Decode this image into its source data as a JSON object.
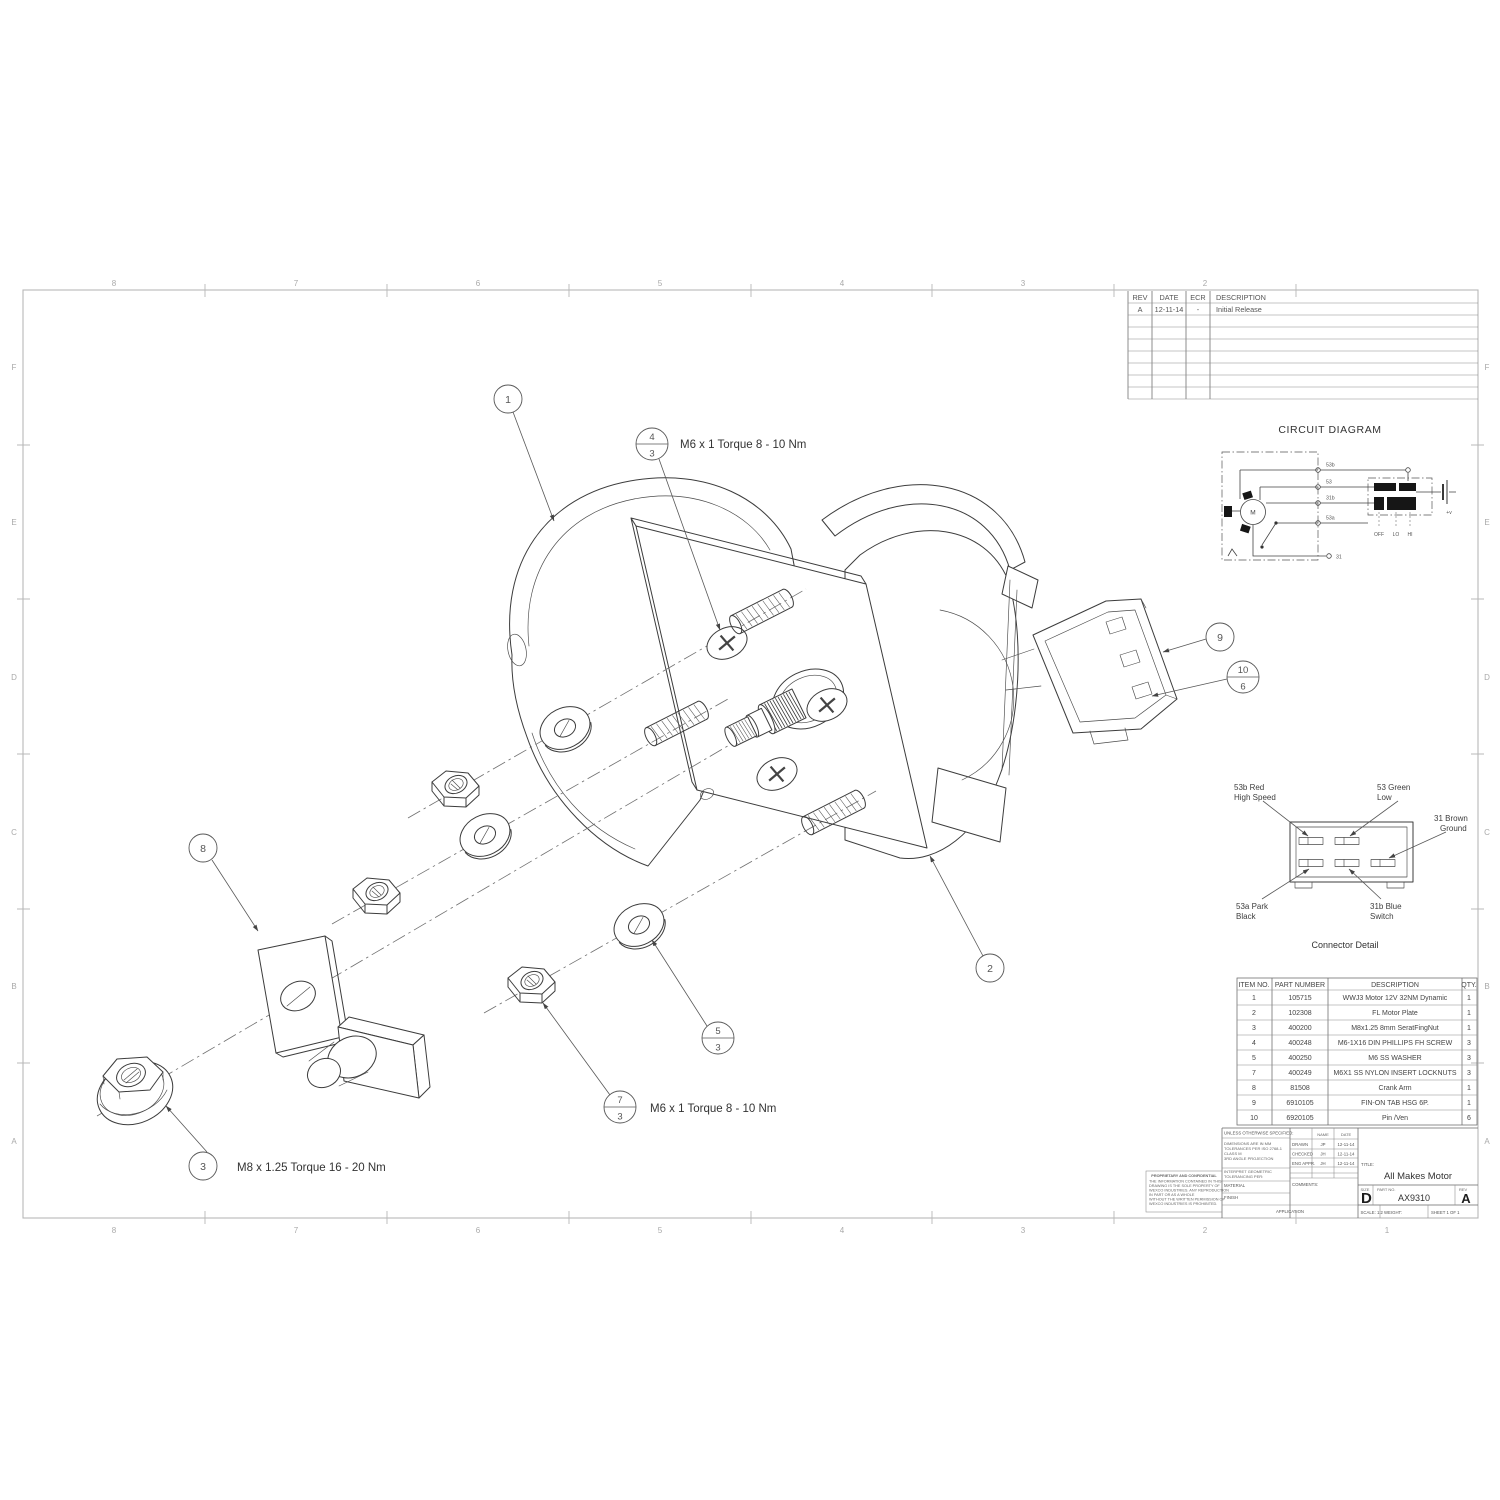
{
  "sheet": {
    "zones": {
      "columns": [
        "8",
        "7",
        "6",
        "5",
        "4",
        "3",
        "2",
        "1"
      ],
      "rows": [
        "F",
        "E",
        "D",
        "C",
        "B",
        "A"
      ]
    },
    "revisions": {
      "headers": {
        "rev": "REV",
        "date": "DATE",
        "ecr": "ECR",
        "description": "DESCRIPTION"
      },
      "rows": [
        {
          "rev": "A",
          "date": "12-11-14",
          "ecr": "-",
          "description": "Initial Release"
        }
      ]
    },
    "circuit": {
      "title": "CIRCUIT DIAGRAM",
      "motor": "M",
      "wires": {
        "w53b": "53b",
        "w53": "53",
        "w31b": "31b",
        "w53a": "53a",
        "w31": "31"
      },
      "switch": {
        "off": "OFF",
        "lo": "LO",
        "hi": "HI"
      },
      "power": "+v"
    },
    "connector": {
      "title": "Connector Detail",
      "labels": {
        "high_speed_1": "53b Red",
        "high_speed_2": "High Speed",
        "low_1": "53 Green",
        "low_2": "Low",
        "ground_1": "31 Brown",
        "ground_2": "Ground",
        "park_1": "53a Park",
        "park_2": "Black",
        "switch_1": "31b Blue",
        "switch_2": "Switch"
      }
    },
    "bom": {
      "headers": [
        "ITEM NO.",
        "PART NUMBER",
        "DESCRIPTION",
        "QTY."
      ],
      "rows": [
        [
          "1",
          "105715",
          "WWJ3 Motor 12V 32NM Dynamic",
          "1"
        ],
        [
          "2",
          "102308",
          "FL Motor Plate",
          "1"
        ],
        [
          "3",
          "400200",
          "M8x1.25 8mm SeratFingNut",
          "1"
        ],
        [
          "4",
          "400248",
          "M6-1X16 DIN PHILLIPS FH SCREW",
          "3"
        ],
        [
          "5",
          "400250",
          "M6 SS WASHER",
          "3"
        ],
        [
          "7",
          "400249",
          "M6X1 SS NYLON INSERT LOCKNUTS",
          "3"
        ],
        [
          "8",
          "81508",
          "Crank Arm",
          "1"
        ],
        [
          "9",
          "6910105",
          "FIN-ON TAB HSG 6P.",
          "1"
        ],
        [
          "10",
          "6920105",
          "Pin /Ven",
          "6"
        ]
      ]
    },
    "annotations": {
      "torque_m6_top": "M6 x 1 Torque 8 - 10 Nm",
      "torque_m6_bottom": "M6 x 1 Torque 8 - 10 Nm",
      "torque_m8": "M8 x 1.25 Torque 16 - 20 Nm"
    },
    "balloons": {
      "b1": "1",
      "b2": "2",
      "b3": "3",
      "b4_top": "4",
      "b4_bottom": "3",
      "b5_top": "5",
      "b5_bottom": "3",
      "b7_top": "7",
      "b7_bottom": "3",
      "b8": "8",
      "b9": "9",
      "b10_top": "10",
      "b10_bottom": "6"
    },
    "title_block": {
      "proprietary_title": "PROPRIETARY AND CONFIDENTIAL",
      "proprietary_lines": [
        "THE INFORMATION CONTAINED IN THIS",
        "DRAWING IS THE SOLE PROPERTY OF",
        "WEXCO INDUSTRIES. ANY REPRODUCTION",
        "IN PART OR AS A WHOLE",
        "WITHOUT THE WRITTEN PERMISSION OF",
        "WEXCO INDUSTRIES IS PROHIBITED."
      ],
      "spec_header": "UNLESS OTHERWISE SPECIFIED:",
      "spec_lines": [
        "DIMENSIONS ARE IN MM",
        "TOLERANCES PER ISO 2768-1",
        "CLASS M",
        "3RD ANGLE PROJECTION"
      ],
      "interpret_lines": [
        "INTERPRET GEOMETRIC",
        "TOLERANCING PER:"
      ],
      "material_label": "MATERIAL",
      "finish_label": "FINISH",
      "application_label": "APPLICATION",
      "name_header": "NAME",
      "date_header": "DATE",
      "sign_rows": [
        {
          "role": "DRAWN",
          "name": "JP",
          "date": "12-11-14"
        },
        {
          "role": "CHECKED",
          "name": "JH",
          "date": "12-11-14"
        },
        {
          "role": "ENG APPR.",
          "name": "JH",
          "date": "12-11-14"
        }
      ],
      "comments_label": "COMMENTS:",
      "title_label": "TITLE:",
      "title": "All Makes Motor",
      "size_label": "SIZE",
      "size": "D",
      "part_label": "PART NO.",
      "part_number": "AX9310",
      "rev_label": "REV",
      "revision": "A",
      "scale": "SCALE: 1:2",
      "weight": "WEIGHT:",
      "sheet": "SHEET 1 OF 1"
    }
  }
}
